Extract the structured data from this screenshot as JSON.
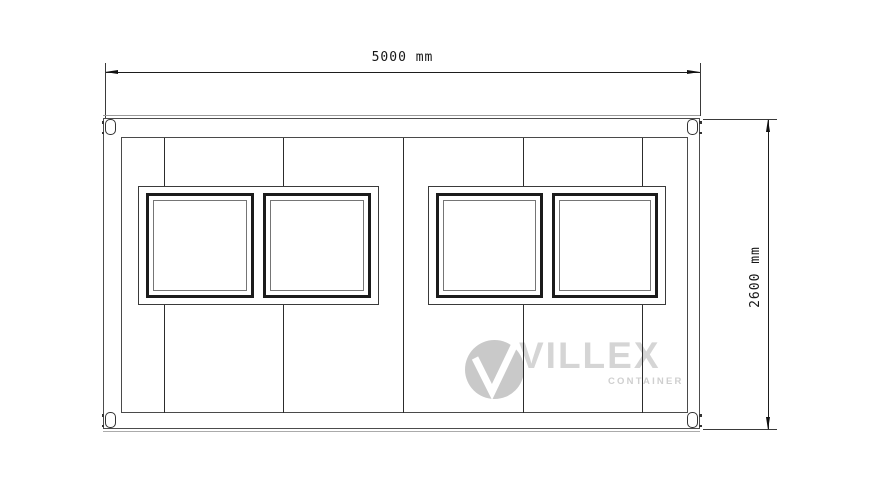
{
  "drawing": {
    "type": "container-front-elevation",
    "panel_seam_count": 5,
    "window_pair_count": 2,
    "windows_per_pair": 2,
    "corner_casting_count": 4
  },
  "dimensions": {
    "width_label": "5000 mm",
    "height_label": "2600 mm"
  },
  "watermark": {
    "monogram": "V",
    "brand": "VILLEX",
    "subtitle": "CONTAINER"
  },
  "colors": {
    "line_dark": "#1b1b1b",
    "line_mid": "#4a4a4a",
    "line_light": "#9a9a9a",
    "watermark_gray": "#c9c9c9",
    "background": "#ffffff"
  }
}
